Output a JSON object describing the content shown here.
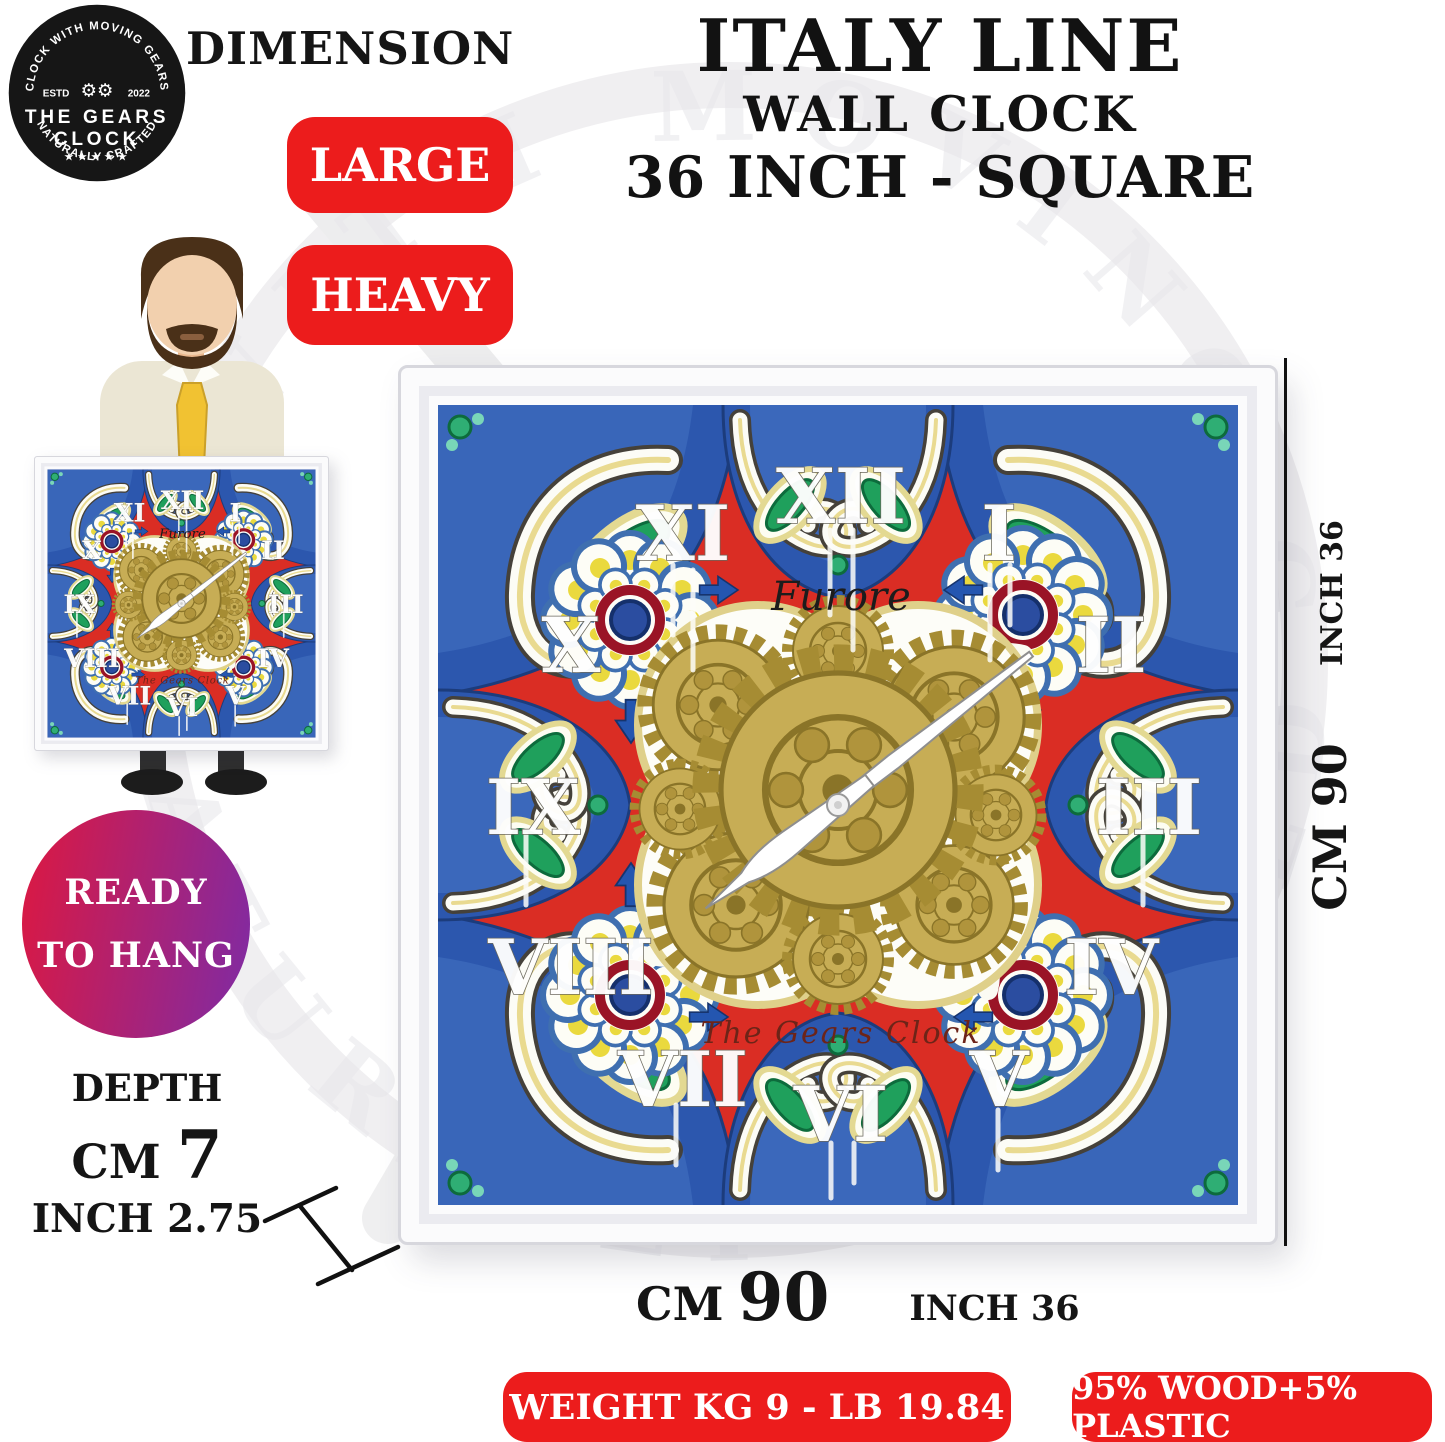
{
  "logo": {
    "arc_top": "CLOCK WITH MOVING GEARS",
    "estd": "ESTD",
    "year": "2022",
    "gears_glyph": "⚙⚙",
    "title_line1": "THE GEARS",
    "title_line2": "CLOCK",
    "stars": "★★★★★",
    "arc_bottom": "NATURALLY CRAFTED"
  },
  "header": {
    "dimension_label": "DIMENSION",
    "size_badges": [
      "LARGE",
      "HEAVY"
    ],
    "title_line1": "ITALY LINE",
    "title_line2": "WALL CLOCK",
    "title_line3": "36 INCH - SQUARE"
  },
  "ready_badge": {
    "line1": "READY",
    "line2": "TO HANG"
  },
  "depth": {
    "label": "DEPTH",
    "cm_label": "CM",
    "cm_value": "7",
    "inch_label": "INCH",
    "inch_value": "2.75"
  },
  "clock": {
    "numerals": [
      "XII",
      "I",
      "II",
      "III",
      "IV",
      "V",
      "VI",
      "VII",
      "VIII",
      "IX",
      "X",
      "XI"
    ],
    "face_brand": "Furore",
    "maker_signature": "The Gears Clock"
  },
  "dimensions": {
    "side_inch": "INCH 36",
    "side_cm": "CM 90",
    "bottom_cm_label": "CM",
    "bottom_cm_value": "90",
    "bottom_inch": "INCH 36"
  },
  "footer_badges": [
    "WEIGHT KG 9 - LB 19.84",
    "95% WOOD+5% PLASTIC"
  ],
  "colors": {
    "badge_red": "#ec1c1c",
    "ready_gradient_left": "#dd1840",
    "ready_gradient_right": "#7e2ba5",
    "tile_red": "#da2d24",
    "tile_blue": "#2c57ae",
    "gear_gold": "#c7ad55",
    "leaf_green": "#1fa05c",
    "text_black": "#141414"
  }
}
